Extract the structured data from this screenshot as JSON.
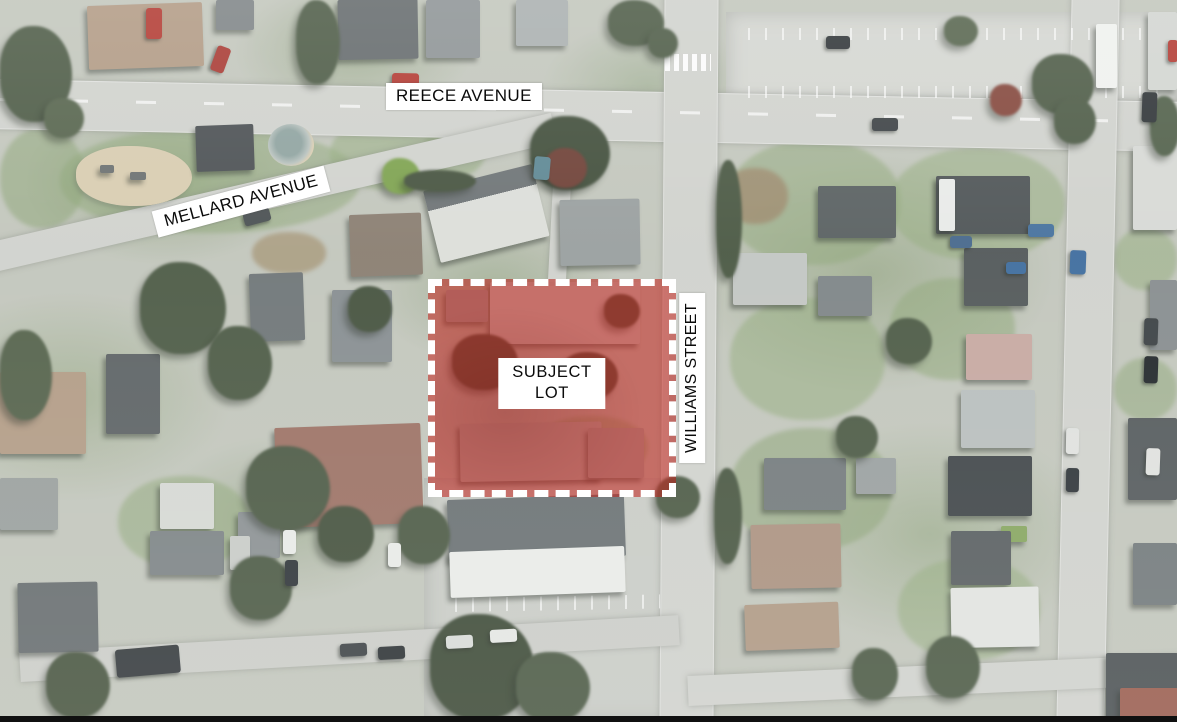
{
  "map": {
    "description": "Aerial site plan with subject lot highlighted",
    "street_labels": {
      "reece": "REECE AVENUE",
      "mellard": "MELLARD AVENUE",
      "williams": "WILLIAMS STREET"
    },
    "subject_lot": {
      "label_line1": "SUBJECT",
      "label_line2": "LOT",
      "fill_color": "#c2231c",
      "fill_opacity": 0.55,
      "border_color": "#ffffff"
    },
    "palette": {
      "road": "#d0d2cd",
      "ground": "#c2c6bc",
      "lawn": "#92a97d",
      "trees": "#4d5b46",
      "parking": "#d4d6d1",
      "sand": "#d8ccb0",
      "frame_bottom": "#101010"
    }
  }
}
